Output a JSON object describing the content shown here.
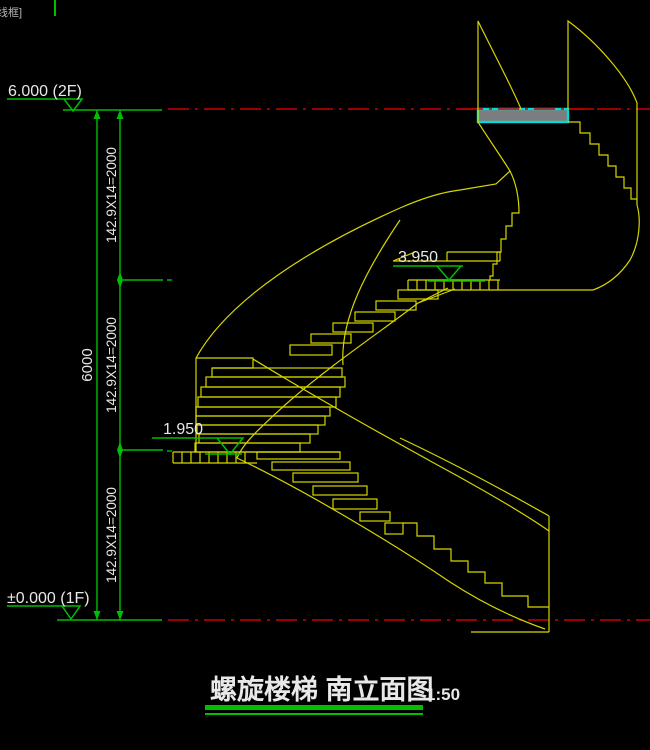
{
  "viewport": {
    "label": "线框]"
  },
  "colors": {
    "background": "#000000",
    "stair_yellow": "#d6d600",
    "dimension_green": "#00be00",
    "datum_red": "#cc0000",
    "slab_border_cyan": "#00dcdc",
    "slab_fill_gray": "#7d7d7d",
    "text_white": "#e8e8e8"
  },
  "elevation_labels": {
    "floor2": "6.000 (2F)",
    "upper_landing": "3.950",
    "lower_landing": "1.950",
    "floor1": "±0.000 (1F)"
  },
  "dimensions": {
    "overall": "6000",
    "segments": [
      "142.9X14=2000",
      "142.9X14=2000",
      "142.9X14=2000"
    ]
  },
  "title": {
    "text": "螺旋楼梯 南立面图",
    "scale": "1:50"
  }
}
